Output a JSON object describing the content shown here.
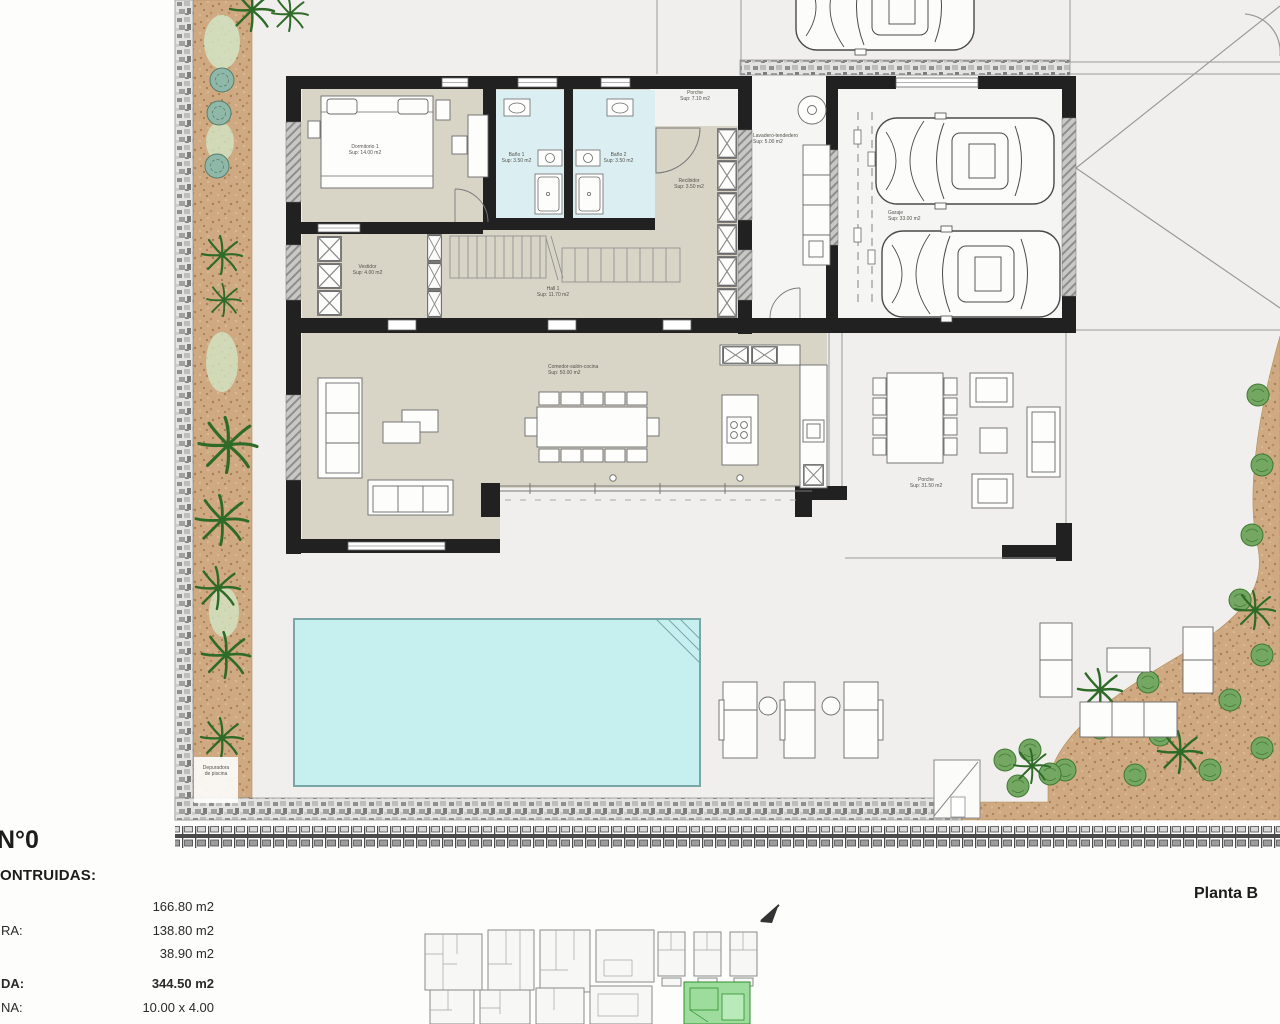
{
  "meta": {
    "plan_number": "N°0",
    "planta_label": "Planta B"
  },
  "summary": {
    "heading": "ONTRUIDAS:",
    "rows": [
      {
        "label": "",
        "value": "166.80 m2"
      },
      {
        "label": "RA:",
        "value": "138.80 m2"
      },
      {
        "label": "",
        "value": "38.90 m2"
      },
      {
        "label": "DA:",
        "value": "344.50 m2"
      },
      {
        "label": "NA:",
        "value": "10.00 x 4.00"
      }
    ]
  },
  "rooms": {
    "dormitorio": {
      "name": "Dormitorio 1",
      "area": "Sup: 14.00 m2"
    },
    "bano1": {
      "name": "Baño 1",
      "area": "Sup: 3.50 m2"
    },
    "bano2": {
      "name": "Baño 2",
      "area": "Sup: 3.50 m2"
    },
    "porche_entrada": {
      "name": "Porche",
      "area": "Sup: 7.10 m2"
    },
    "recibidor": {
      "name": "Recibidor",
      "area": "Sup: 3.50 m2"
    },
    "vestidor": {
      "name": "Vestidor",
      "area": "Sup: 4.00 m2"
    },
    "hall": {
      "name": "Hall 1",
      "area": "Sup: 11.70 m2"
    },
    "salon_cocina": {
      "name": "Comedor-salón-cocina",
      "area": "Sup: 50.00 m2"
    },
    "lavadero": {
      "name": "Lavadero-tendedero",
      "area": "Sup: 5.00 m2"
    },
    "garaje": {
      "name": "Garaje",
      "area": "Sup: 33.00 m2"
    },
    "porche": {
      "name": "Porche",
      "area": "Sup: 31.50 m2"
    },
    "depuradora": {
      "name": "Depuradora",
      "area": "de piscina"
    }
  },
  "colors": {
    "wall_dark": "#212121",
    "floor_beige": "#d8d4c6",
    "bath_cyan": "#dbeff3",
    "pool_cyan": "#c6eff0",
    "garden_sand": "#cfa981",
    "plant_green": "#3f7d35",
    "highlight_green": "#9ddc9d"
  }
}
